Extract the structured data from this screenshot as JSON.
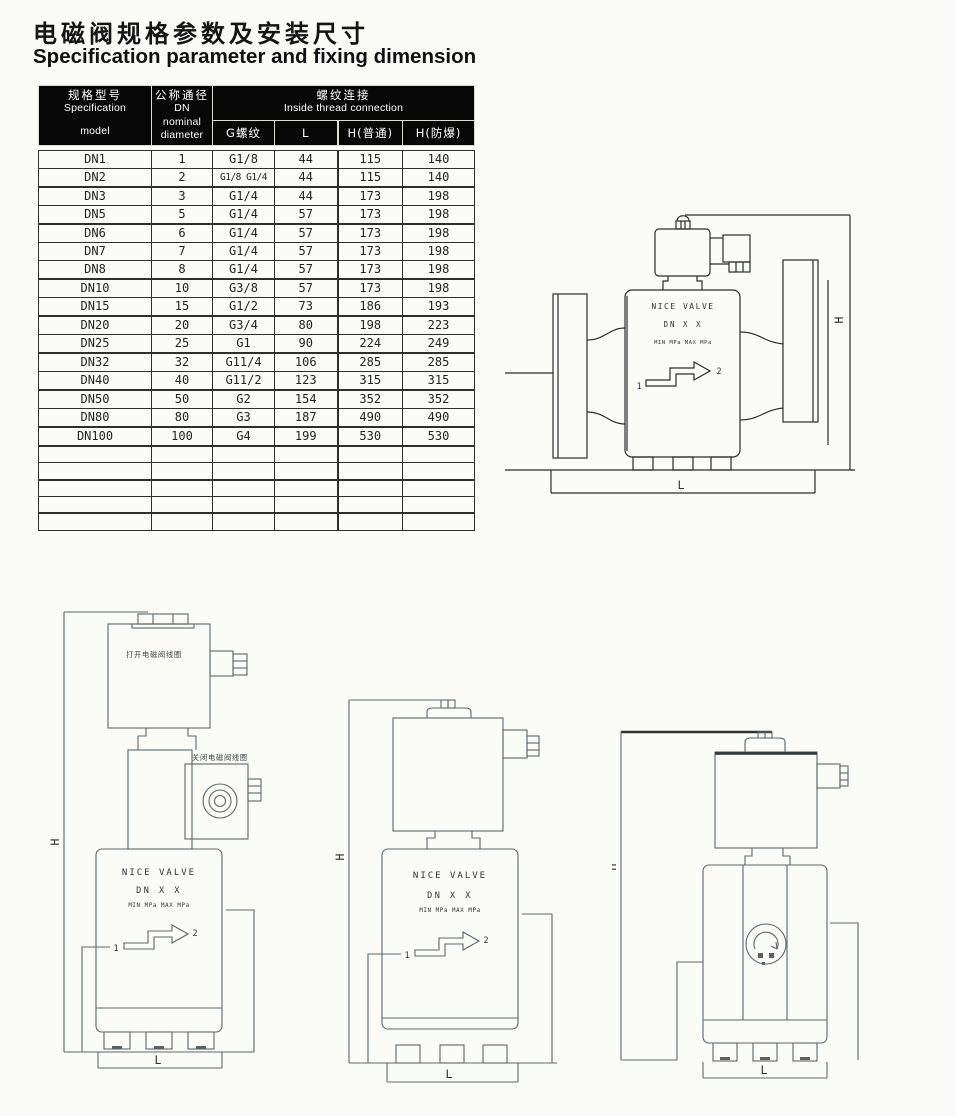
{
  "page": {
    "title_zh": "电磁阀规格参数及安装尺寸",
    "title_en": "Specification parameter and fixing dimension"
  },
  "table": {
    "header": {
      "model_lines": [
        "规格型号",
        "Specification",
        "model"
      ],
      "dn_lines": [
        "公称通径",
        "DN",
        "nominal",
        "diameter"
      ],
      "group_lines": [
        "螺纹连接",
        "Inside thread connection"
      ],
      "sub": [
        "G螺纹",
        "L",
        "H(普通)",
        "H(防爆)"
      ]
    },
    "rows": [
      {
        "model": "DN1",
        "dn": "1",
        "g": "G1/8",
        "l": "44",
        "h_normal": "115",
        "h_ex": "140"
      },
      {
        "model": "DN2",
        "dn": "2",
        "g": "G1/8 G1/4",
        "l": "44",
        "h_normal": "115",
        "h_ex": "140"
      },
      {
        "model": "DN3",
        "dn": "3",
        "g": "G1/4",
        "l": "44",
        "h_normal": "173",
        "h_ex": "198"
      },
      {
        "model": "DN5",
        "dn": "5",
        "g": "G1/4",
        "l": "57",
        "h_normal": "173",
        "h_ex": "198"
      },
      {
        "model": "DN6",
        "dn": "6",
        "g": "G1/4",
        "l": "57",
        "h_normal": "173",
        "h_ex": "198"
      },
      {
        "model": "DN7",
        "dn": "7",
        "g": "G1/4",
        "l": "57",
        "h_normal": "173",
        "h_ex": "198"
      },
      {
        "model": "DN8",
        "dn": "8",
        "g": "G1/4",
        "l": "57",
        "h_normal": "173",
        "h_ex": "198"
      },
      {
        "model": "DN10",
        "dn": "10",
        "g": "G3/8",
        "l": "57",
        "h_normal": "173",
        "h_ex": "198"
      },
      {
        "model": "DN15",
        "dn": "15",
        "g": "G1/2",
        "l": "73",
        "h_normal": "186",
        "h_ex": "193"
      },
      {
        "model": "DN20",
        "dn": "20",
        "g": "G3/4",
        "l": "80",
        "h_normal": "198",
        "h_ex": "223"
      },
      {
        "model": "DN25",
        "dn": "25",
        "g": "G1",
        "l": "90",
        "h_normal": "224",
        "h_ex": "249"
      },
      {
        "model": "DN32",
        "dn": "32",
        "g": "G11/4",
        "l": "106",
        "h_normal": "285",
        "h_ex": "285"
      },
      {
        "model": "DN40",
        "dn": "40",
        "g": "G11/2",
        "l": "123",
        "h_normal": "315",
        "h_ex": "315"
      },
      {
        "model": "DN50",
        "dn": "50",
        "g": "G2",
        "l": "154",
        "h_normal": "352",
        "h_ex": "352"
      },
      {
        "model": "DN80",
        "dn": "80",
        "g": "G3",
        "l": "187",
        "h_normal": "490",
        "h_ex": "490"
      },
      {
        "model": "DN100",
        "dn": "100",
        "g": "G4",
        "l": "199",
        "h_normal": "530",
        "h_ex": "530"
      }
    ]
  },
  "drawings": {
    "body_label": [
      "NICE VALVE",
      "DN X X",
      "MIN  MPa MAX  MPa"
    ],
    "port_in": "1",
    "port_out": "2",
    "dim_h": "H",
    "dim_l": "L",
    "open_coil_label": "打开电磁阀线圈",
    "close_coil_label": "关闭电磁阀线圈"
  },
  "colors": {
    "header_bg": "#070707",
    "header_text": "#ffffff",
    "table_line": "#2e2e2e",
    "drawing_line_dark": "#2a2d2f",
    "drawing_line_gray": "#5c676c",
    "page_bg": "#fbfbf8"
  }
}
